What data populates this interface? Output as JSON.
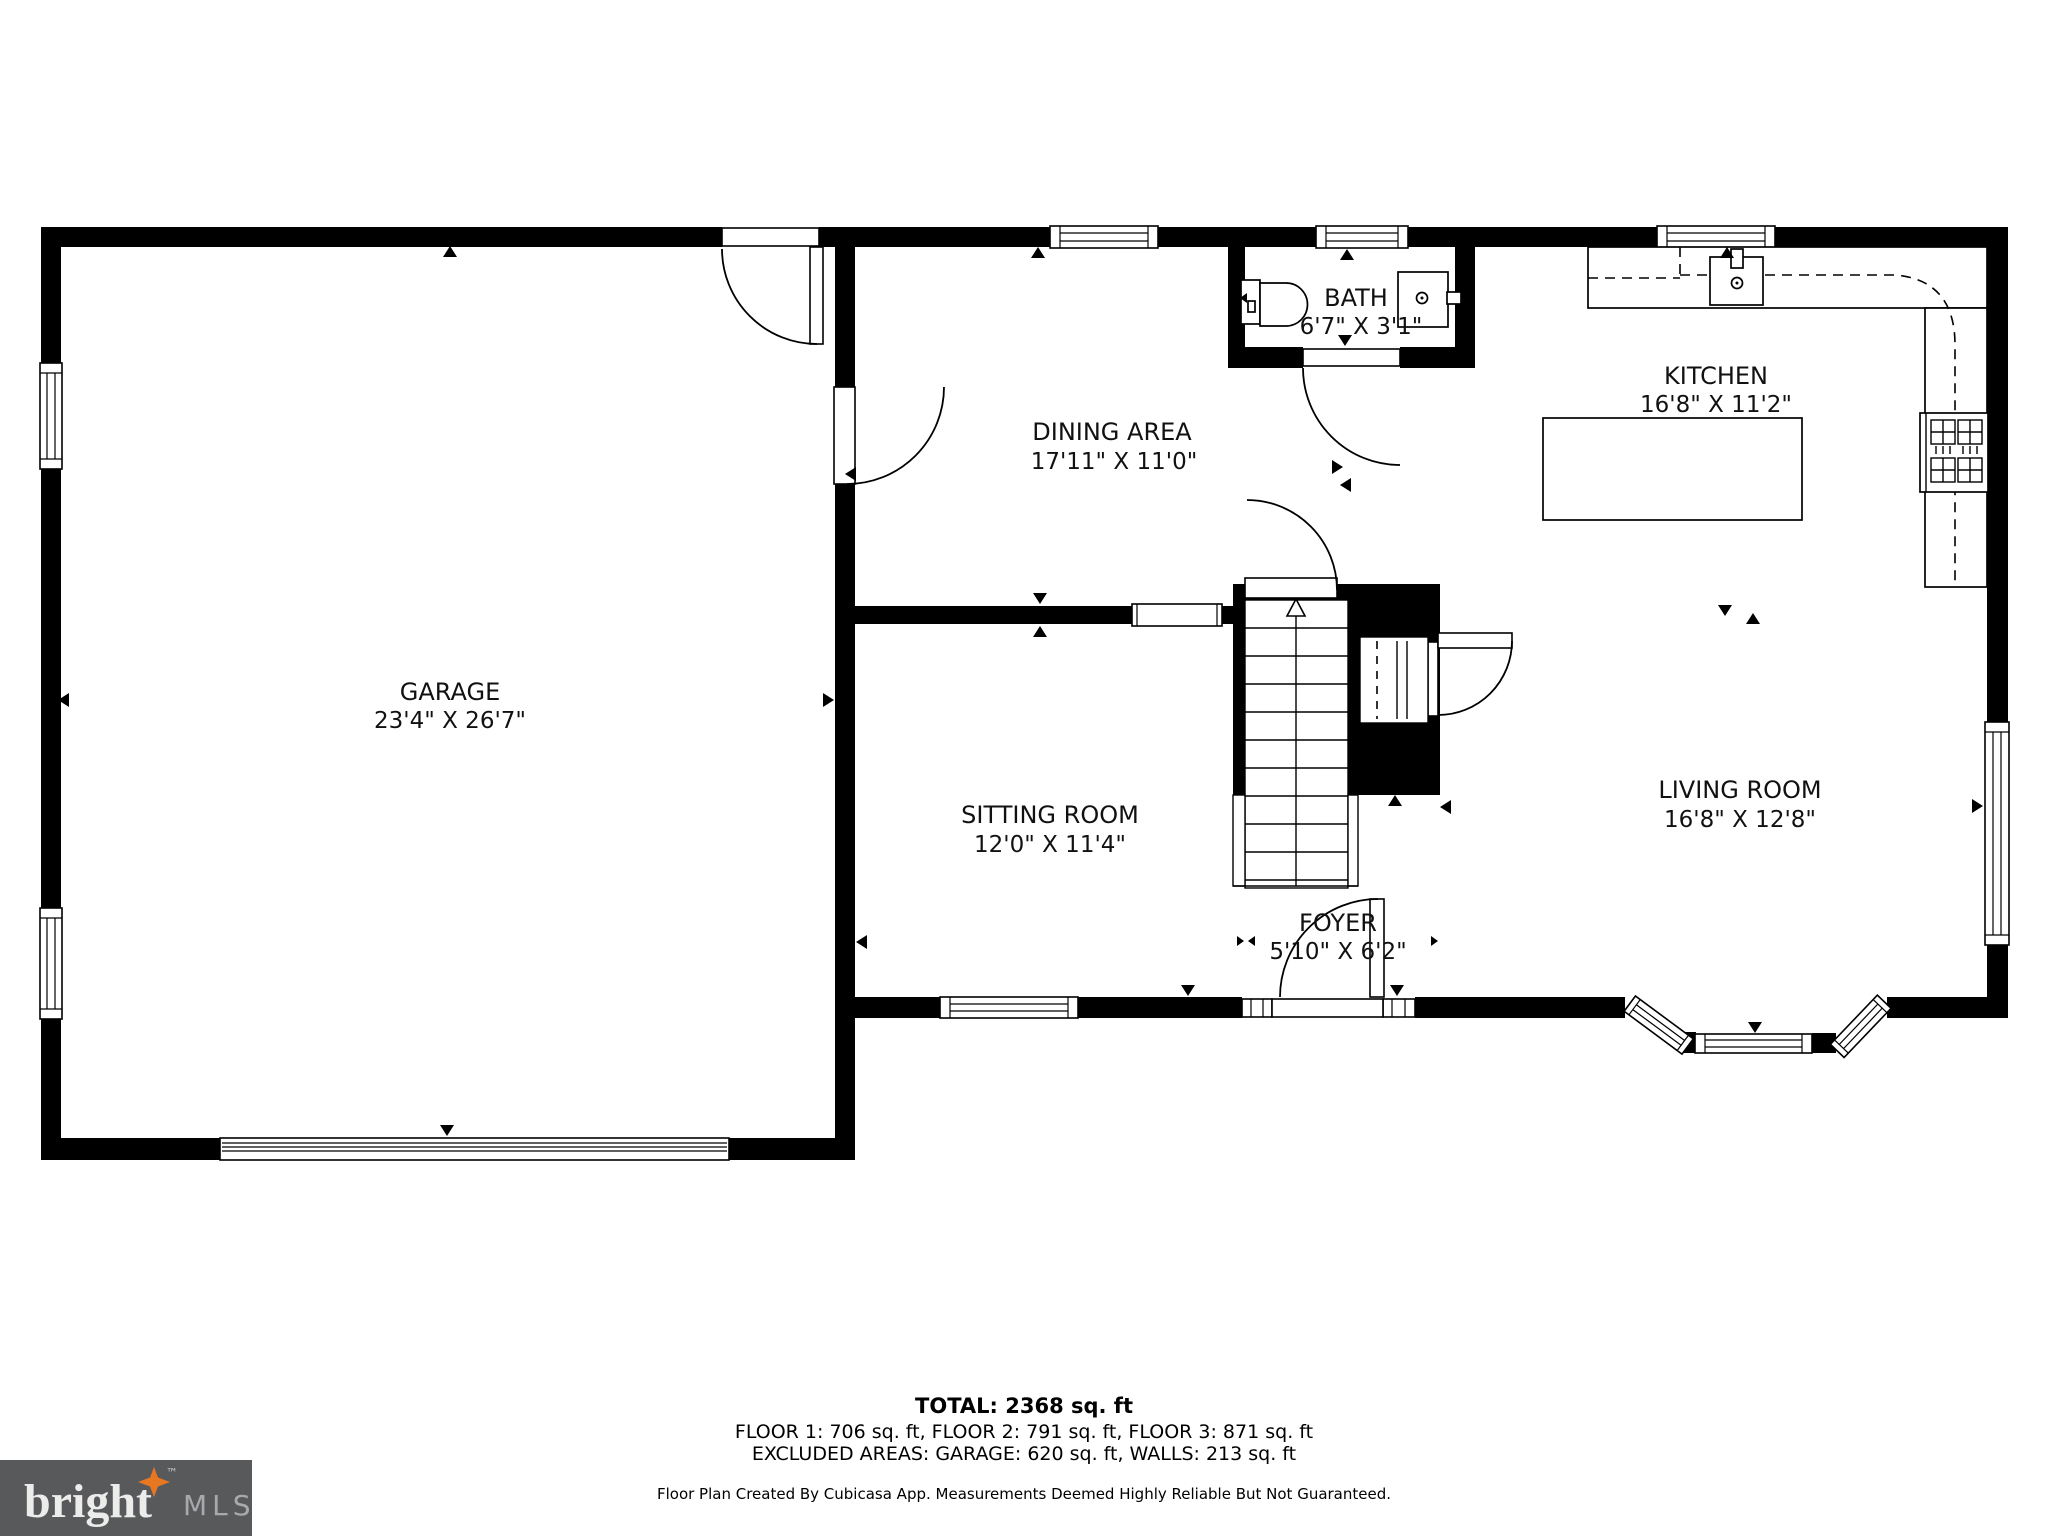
{
  "plan": {
    "rooms": {
      "garage": {
        "name": "GARAGE",
        "dims": "23'4\" X 26'7\""
      },
      "dining": {
        "name": "DINING AREA",
        "dims": "17'11\" X 11'0\""
      },
      "bath": {
        "name": "BATH",
        "dims": "6'7\" X 3'1\""
      },
      "kitchen": {
        "name": "KITCHEN",
        "dims": "16'8\" X 11'2\""
      },
      "sitting": {
        "name": "SITTING ROOM",
        "dims": "12'0\" X 11'4\""
      },
      "living": {
        "name": "LIVING ROOM",
        "dims": "16'8\" X 12'8\""
      },
      "foyer": {
        "name": "FOYER",
        "dims": "5'10\" X 6'2\""
      }
    }
  },
  "footer": {
    "total": "TOTAL: 2368 sq. ft",
    "floors": "FLOOR 1: 706 sq. ft, FLOOR 2: 791 sq. ft, FLOOR 3: 871 sq. ft",
    "excluded": "EXCLUDED AREAS: GARAGE: 620 sq. ft, WALLS: 213 sq. ft",
    "disclaimer": "Floor Plan Created By Cubicasa App. Measurements Deemed Highly Reliable But Not Guaranteed."
  },
  "logo": {
    "brand": "bright",
    "tm": "™",
    "suffix": "MLS"
  },
  "colors": {
    "wall": "#000000",
    "background": "#ffffff",
    "logo_bg": "#58595b",
    "logo_text": "#ececea",
    "logo_star": "#e87722",
    "logo_suffix": "#a7a9ac"
  }
}
